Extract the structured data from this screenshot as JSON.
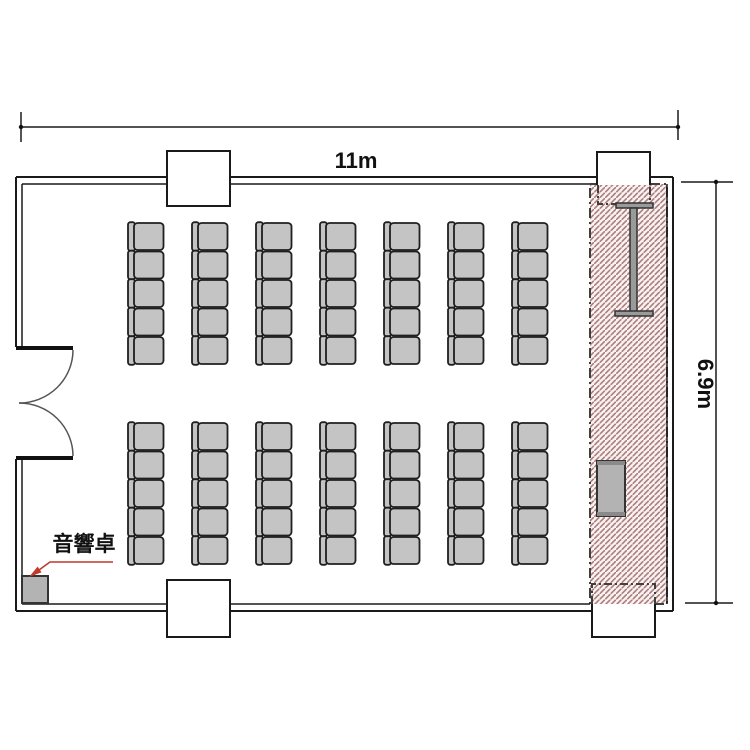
{
  "plan": {
    "type": "room-floor-plan",
    "dimensions": {
      "width": {
        "label": "11m"
      },
      "height": {
        "label": "6.9m"
      }
    },
    "annotations": {
      "audio_desk_label": "音響卓"
    },
    "seating": {
      "blocks": 2,
      "columns": 7,
      "rows_per_block": 5,
      "total_chairs": 70
    },
    "stage": {
      "hatched": true,
      "has_screen": true,
      "has_podium": true
    },
    "door": {
      "type": "double-swing",
      "wall": "left"
    },
    "colors": {
      "wall": "#1a1a1a",
      "chair_fill": "#c4c4c4",
      "chair_stroke": "#1f1f1f",
      "hatch_line": "#ab7f7f",
      "hatch_background": "#faf1f1",
      "leader_red": "#c0392b",
      "furniture_gray": "#b3b3b3"
    }
  }
}
